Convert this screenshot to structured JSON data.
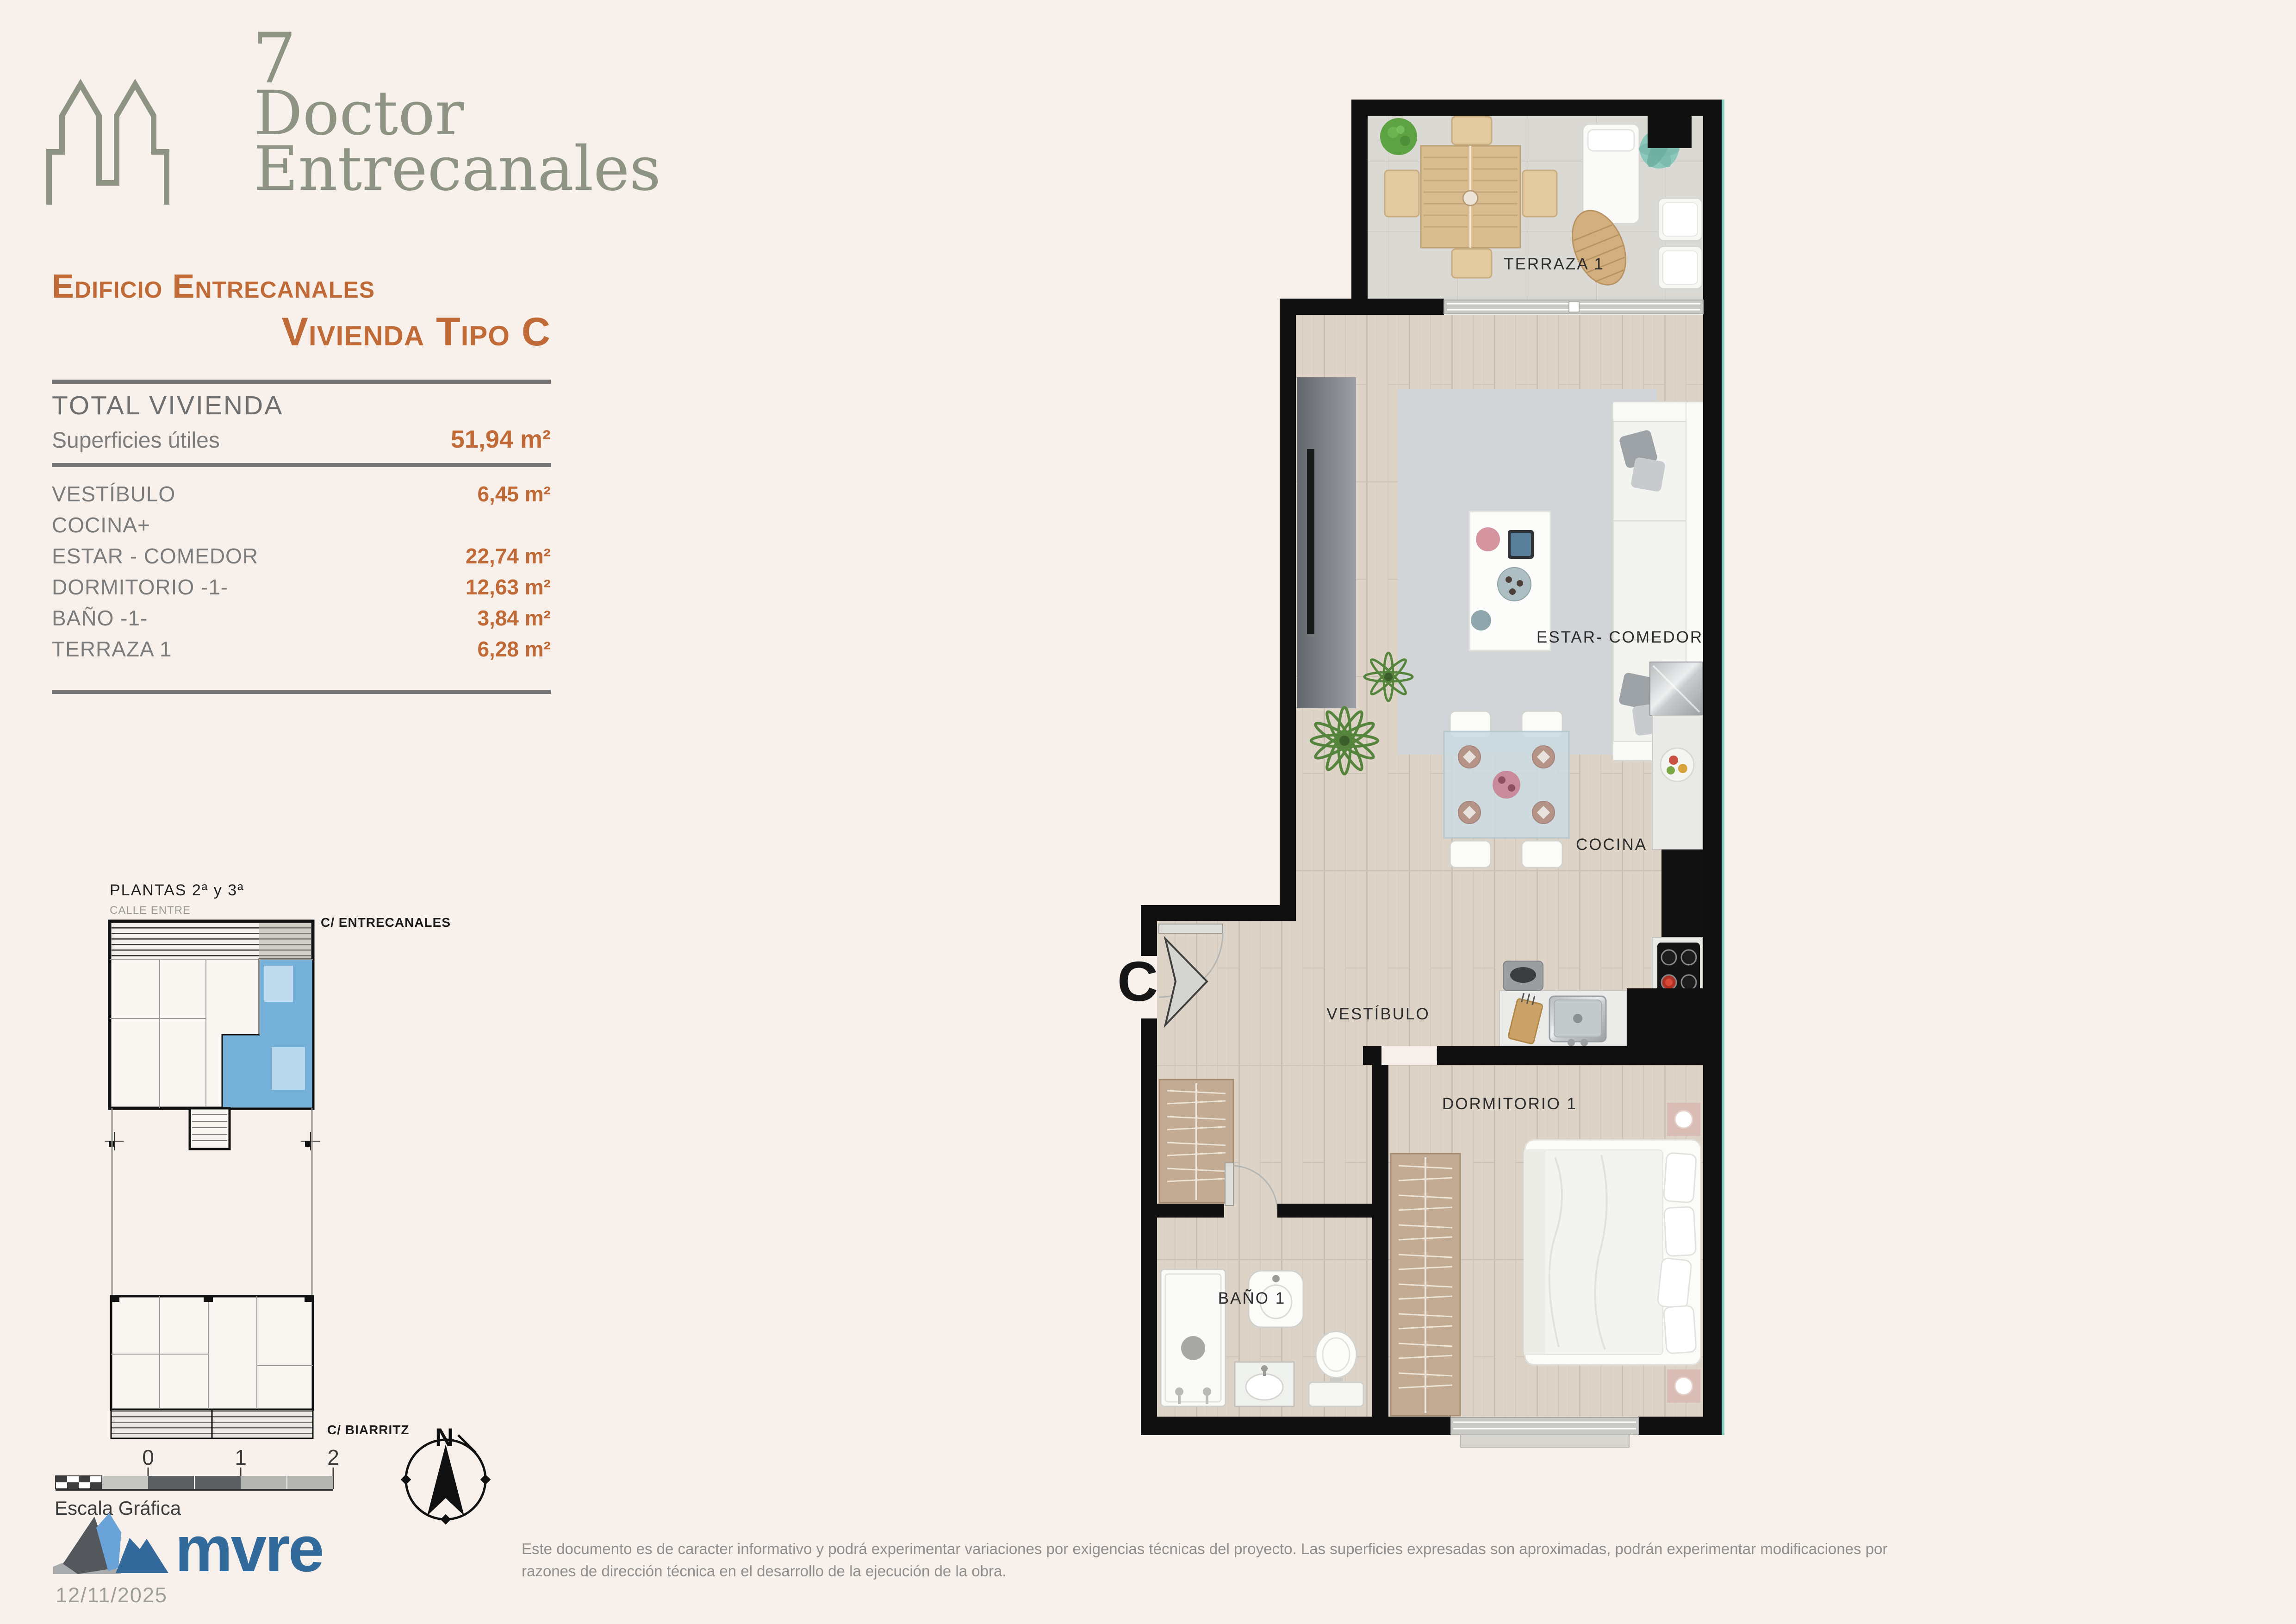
{
  "brand": {
    "number": "7",
    "name_line1": "Doctor",
    "name_line2": "Entrecanales"
  },
  "header": {
    "title_line1": "Edificio Entrecanales",
    "title_line2": "Vivienda Tipo C"
  },
  "summary": {
    "total_label": "TOTAL VIVIENDA",
    "subtitle": "Superficies útiles",
    "total_value": "51,94 m²"
  },
  "rooms": [
    {
      "label": "VESTÍBULO",
      "value": "6,45 m²"
    },
    {
      "label": "COCINA+",
      "value": ""
    },
    {
      "label": "ESTAR - COMEDOR",
      "value": "22,74 m²"
    },
    {
      "label": "DORMITORIO -1-",
      "value": "12,63 m²"
    },
    {
      "label": "BAÑO -1-",
      "value": "3,84 m²"
    },
    {
      "label": "TERRAZA 1",
      "value": "6,28 m²"
    }
  ],
  "site_plan": {
    "title": "PLANTAS  2ª  y 3ª",
    "street_top": "CALLE ENTRE",
    "street_right": "C/ ENTRECANALES",
    "street_bottom": "C/ BIARRITZ"
  },
  "scale_bar": {
    "label": "Escala Gráfica",
    "ticks": [
      "0",
      "1",
      "2"
    ]
  },
  "compass": {
    "label": "N"
  },
  "floor_plan": {
    "entry_label": "C",
    "labels": {
      "terrace": "TERRAZA 1",
      "living": "ESTAR- COMEDOR",
      "kitchen": "COCINA",
      "hall": "VESTÍBULO",
      "bedroom": "DORMITORIO 1",
      "bath": "BAÑO 1"
    }
  },
  "footer": {
    "logo_text": "mvre",
    "date": "12/11/2025",
    "disclaimer_line1": "Este documento es de caracter informativo y podrá experimentar variaciones por exigencias técnicas del proyecto. Las superficies expresadas son aproximadas, podrán experimentar modificaciones por",
    "disclaimer_line2": "razones de dirección técnica en el desarrollo de la ejecución de la obra."
  },
  "colors": {
    "accent": "#c06a38",
    "sage": "#8d9484",
    "highlight_unit": "#74b0d8",
    "logo_blue": "#336a9c",
    "wall": "#101010"
  }
}
